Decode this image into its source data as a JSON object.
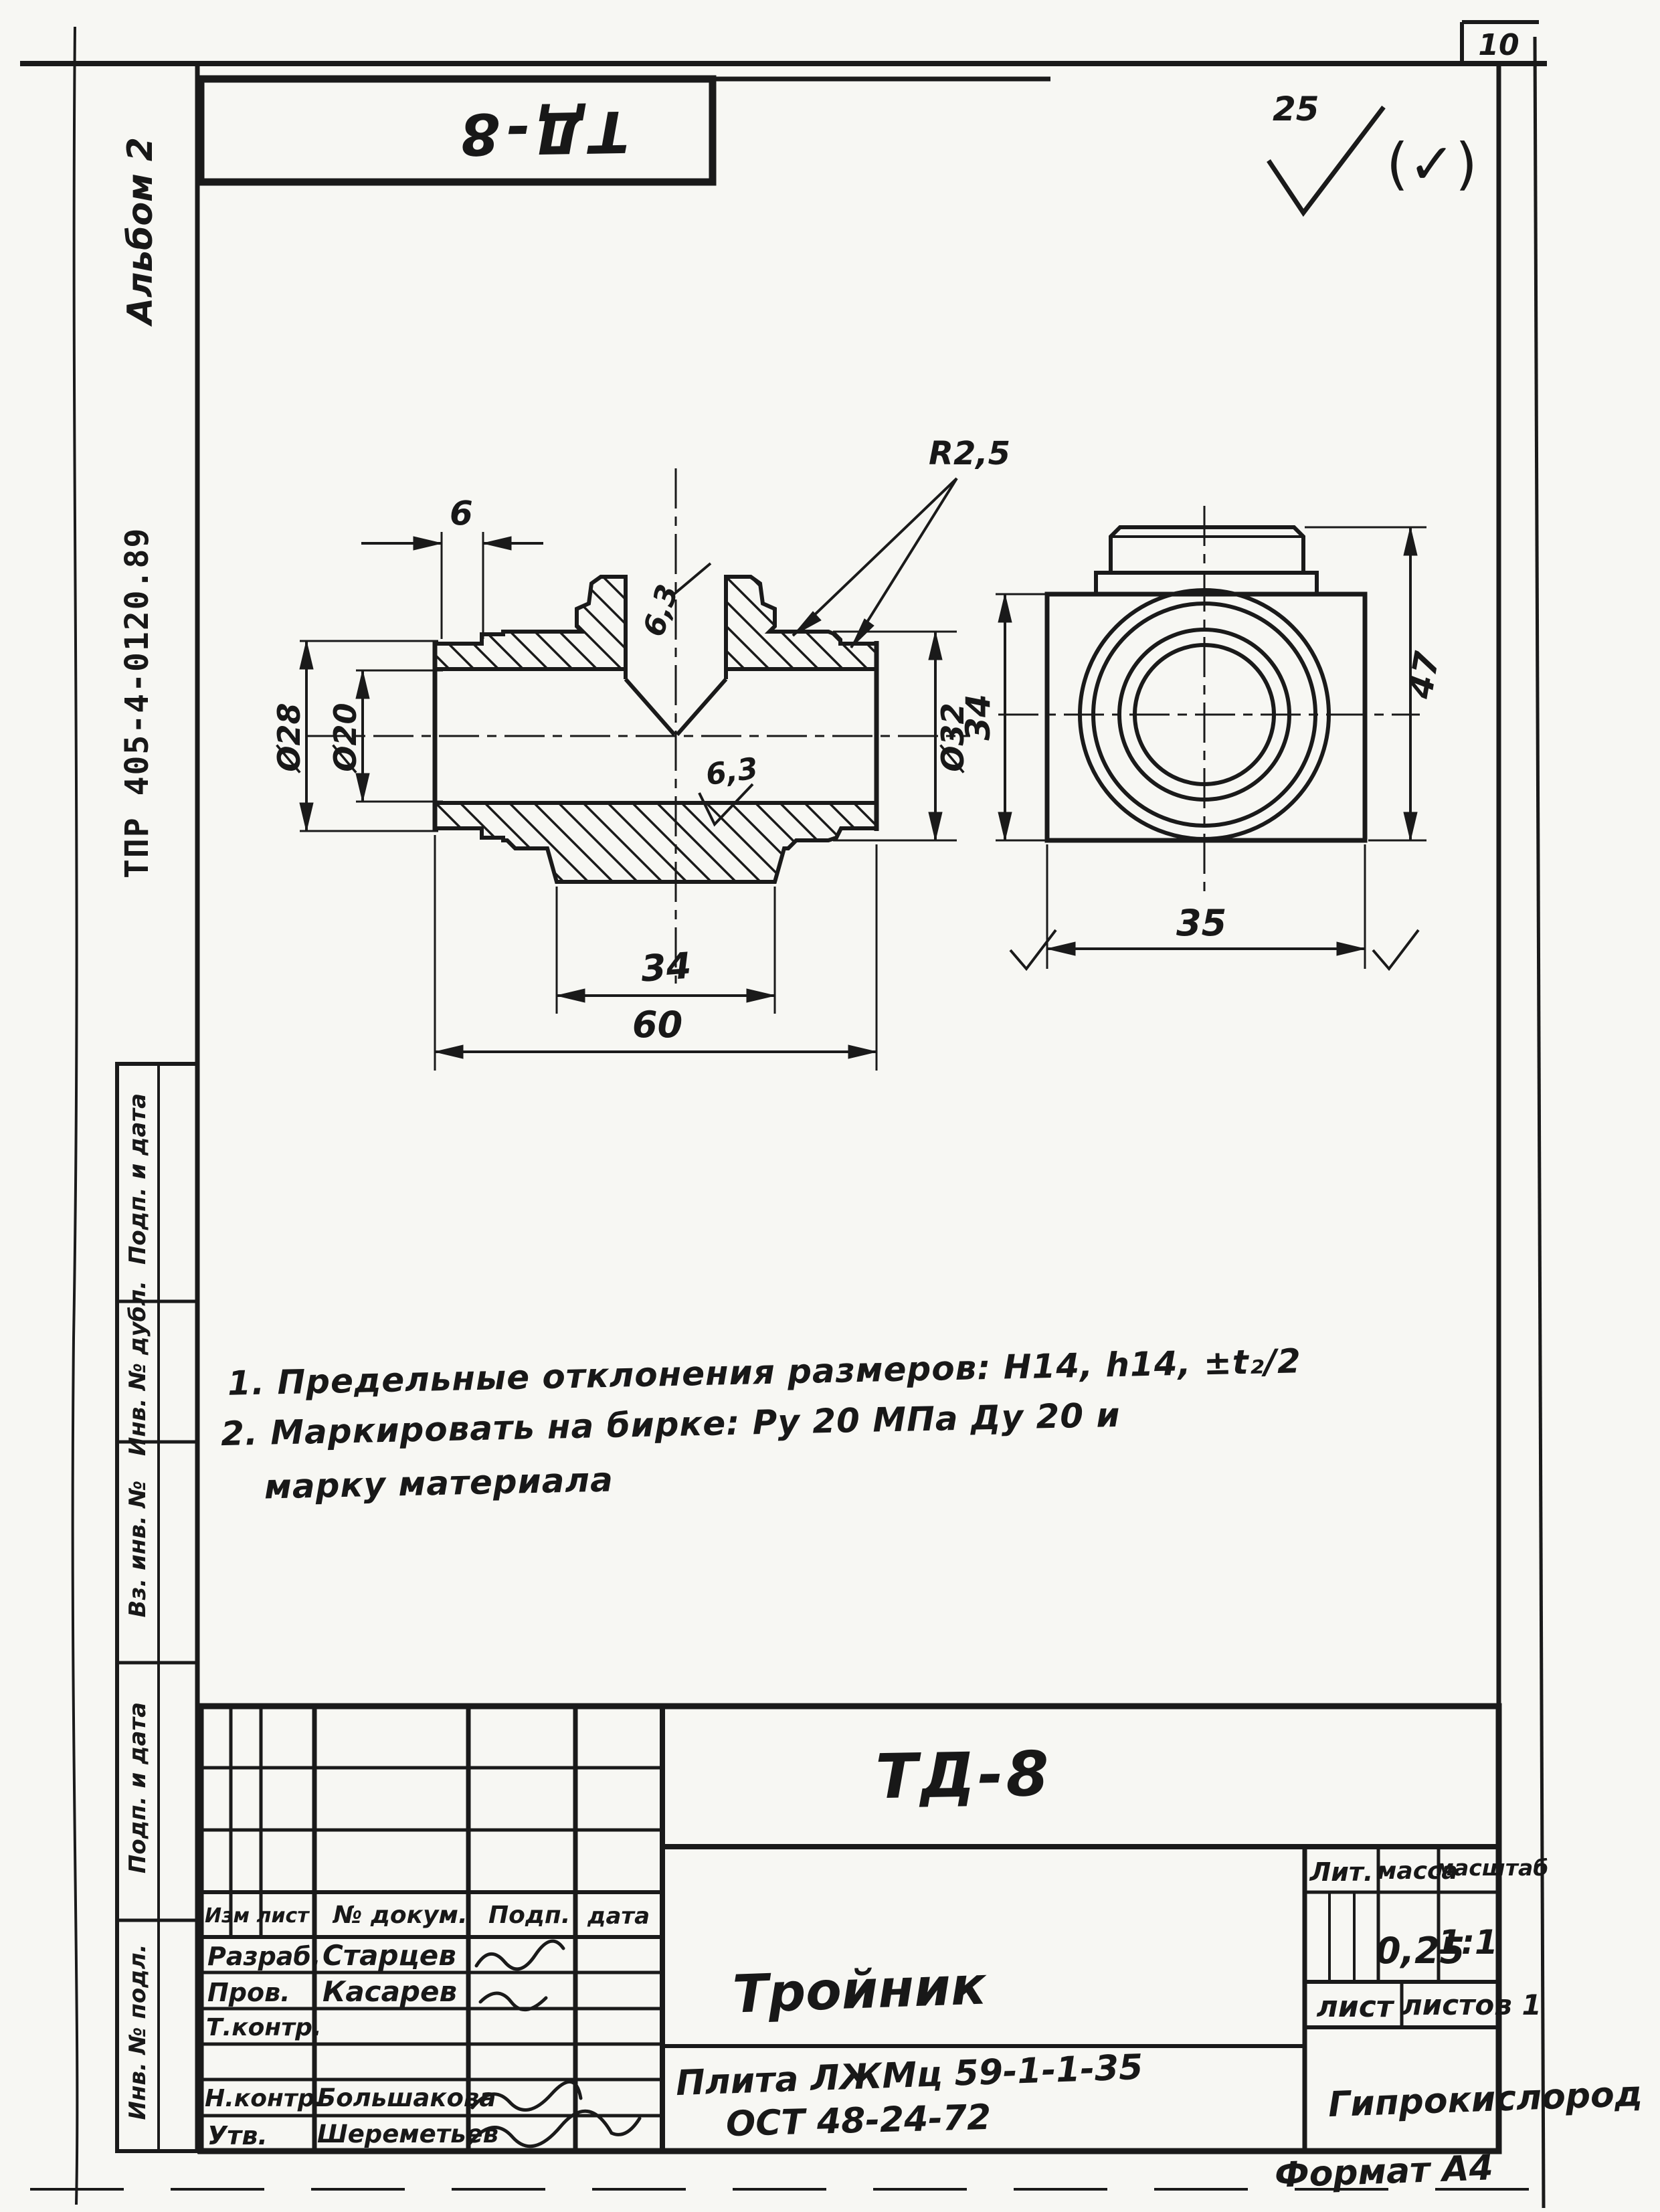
{
  "page": {
    "number": "10",
    "format_note": "Формат А4"
  },
  "roughness": {
    "general_value": "25",
    "bracket_note": "(✓)"
  },
  "top_stamp": {
    "code": "ТД-8"
  },
  "margin": {
    "album": "Альбом 2",
    "doc_code": "ТПР 405-4-0120.89",
    "cells": [
      {
        "label": "Подп. и дата"
      },
      {
        "label": "Инв. № дубл."
      },
      {
        "label": "Вз. инв. №"
      },
      {
        "label": "Подп. и дата"
      },
      {
        "label": "Инв. № подл."
      }
    ]
  },
  "drawing": {
    "section_view": {
      "dims": {
        "collar_width": "6",
        "fillet_radius": "R2,5",
        "rough_top": "6,3",
        "rough_bottom": "6,3",
        "dia_outer_left": "Ø28",
        "dia_bore": "Ø20",
        "dia_outer_right": "Ø32",
        "flange_width": "34",
        "overall_length": "60"
      }
    },
    "end_view": {
      "dims": {
        "square_height": "34",
        "overall_height": "47",
        "square_width": "35"
      }
    }
  },
  "notes": {
    "line1": "1. Предельные отклонения размеров: Н14, h14, ±t₂/2",
    "line2": "2. Маркировать на бирке: Ру 20 МПа Ду 20 и",
    "line3": "марку материала"
  },
  "titleblock": {
    "doc_number": "ТД-8",
    "part_name": "Тройник",
    "material_line1": "Плита ЛЖМц 59-1-1-35",
    "material_line2": "ОСТ 48-24-72",
    "organization": "Гипрокислород",
    "lit_label": "Лит.",
    "mass_label": "масса",
    "scale_label": "масштаб",
    "mass_value": "0,25",
    "scale_value": "1:1",
    "sheet_label": "лист",
    "sheets_label": "листов 1",
    "header": {
      "izm": "Изм  лист",
      "doc": "№ докум.",
      "sign": "Подп.",
      "date": "дата"
    },
    "rows": [
      {
        "role": "Разраб.",
        "name": "Старцев"
      },
      {
        "role": "Пров.",
        "name": "Касарев"
      },
      {
        "role": "Т.контр.",
        "name": ""
      },
      {
        "role": "Н.контр.",
        "name": "Большакова"
      },
      {
        "role": "Утв.",
        "name": "Шереметьев"
      }
    ]
  }
}
